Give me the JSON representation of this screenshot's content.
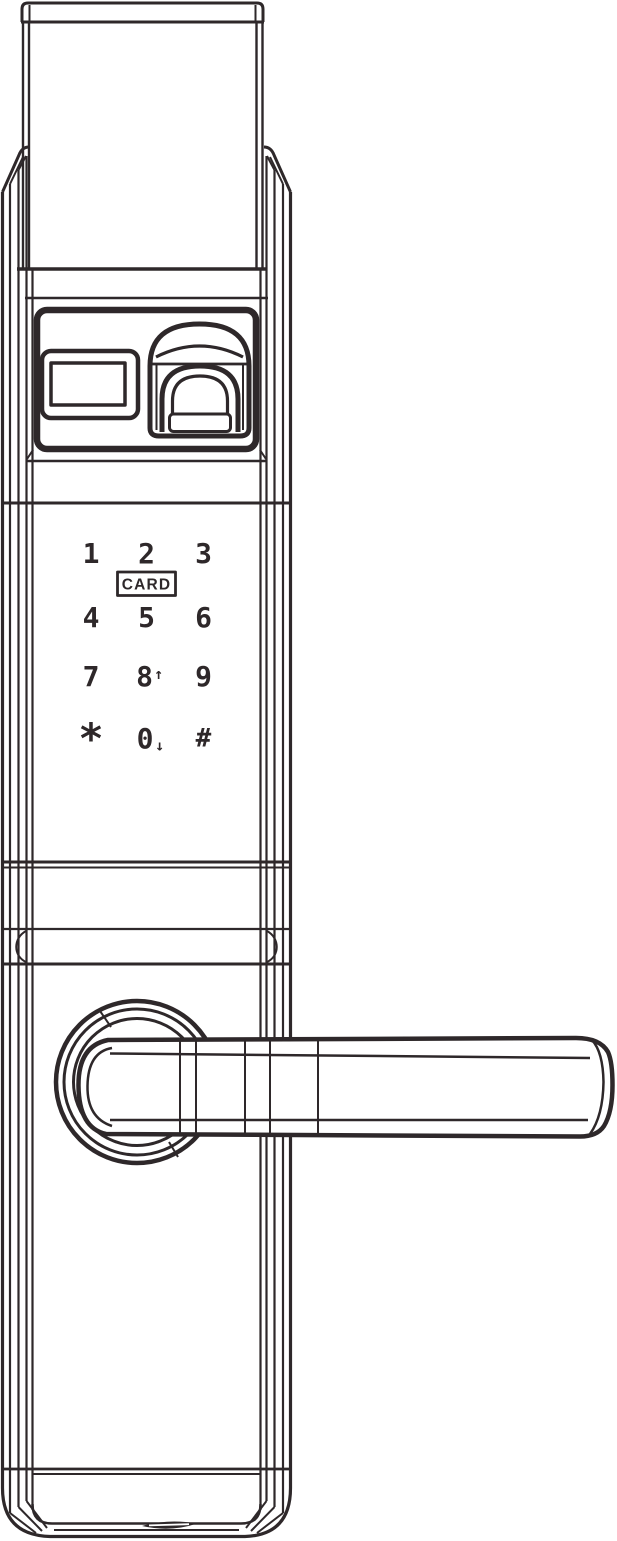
{
  "colors": {
    "line": "#2e282a",
    "background": "#ffffff"
  },
  "keypad": {
    "card_label": "CARD",
    "keys": [
      {
        "label": "1"
      },
      {
        "label": "2"
      },
      {
        "label": "3"
      },
      {
        "label": "4"
      },
      {
        "label": "5"
      },
      {
        "label": "6"
      },
      {
        "label": "7"
      },
      {
        "label": "8",
        "suffix": "↑"
      },
      {
        "label": "9"
      },
      {
        "label": "*"
      },
      {
        "label": "0",
        "suffix": "↓"
      },
      {
        "label": "#"
      }
    ]
  }
}
